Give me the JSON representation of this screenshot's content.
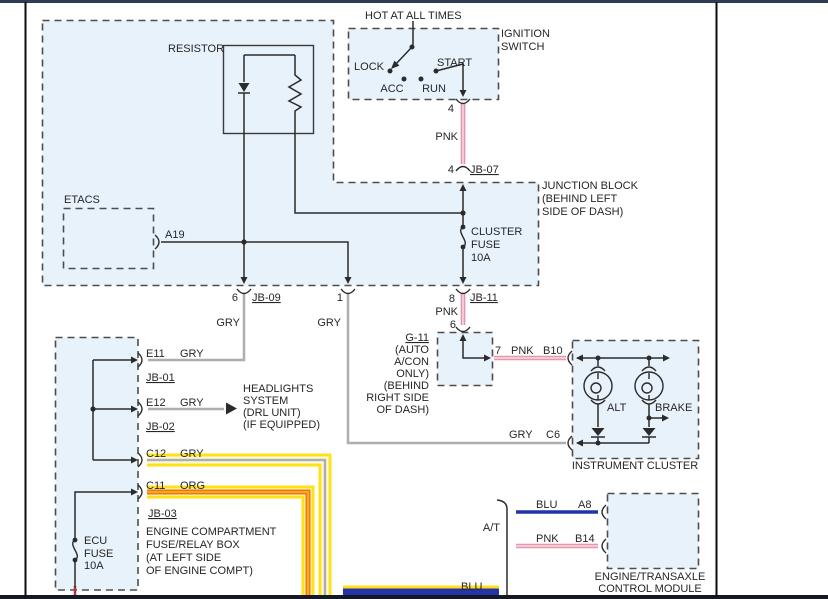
{
  "colors": {
    "box_fill": "#e8f2fa",
    "box_border": "#4d4d4d",
    "wire": "#2b2b2b",
    "text": "#262626",
    "gry": "#aeaeae",
    "pnk_edge": "#dc8aa0",
    "pnk_core": "#f7c9d5",
    "org_edge": "#e26c0c",
    "org_core": "#ffa51f",
    "blu": "#2433a8",
    "red": "#b23434",
    "highlight": "#ffe215",
    "highlight_soft": "#fffbe0",
    "top_bar": "#2d3c50",
    "bottom_bar": "#151923",
    "page_border": "#0b0b0b"
  },
  "feed": {
    "hot": "HOT AT ALL TIMES"
  },
  "ignition": {
    "label1": "IGNITION",
    "label2": "SWITCH",
    "lock": "LOCK",
    "acc": "ACC",
    "run": "RUN",
    "start": "START",
    "pin_out": "4",
    "wire": "PNK",
    "pin_in": "4",
    "connector": "JB-07"
  },
  "resistor": {
    "label": "RESISTOR"
  },
  "etacs": {
    "label": "ETACS",
    "pin": "A19"
  },
  "junction_block": {
    "label1": "JUNCTION BLOCK",
    "label2": "(BEHIND LEFT",
    "label3": "SIDE OF DASH)",
    "fuse1": "CLUSTER",
    "fuse2": "FUSE",
    "fuse3": "10A"
  },
  "jb09": {
    "pin": "6",
    "label": "JB-09",
    "wire": "GRY"
  },
  "jb_mid": {
    "pin": "1",
    "wire": "GRY"
  },
  "jb11": {
    "pin": "8",
    "label": "JB-11",
    "wire": "PNK",
    "pin2": "6"
  },
  "g11": {
    "name": "G-11",
    "note1": "(AUTO",
    "note2": "A/CON",
    "note3": "ONLY)",
    "note4": "(BEHIND",
    "note5": "RIGHT SIDE",
    "note6": "OF DASH)",
    "pin_out": "7"
  },
  "cluster": {
    "title": "INSTRUMENT CLUSTER",
    "wire_in": "PNK",
    "pin_in": "B10",
    "alt": "ALT",
    "brake": "BRAKE",
    "wire_out": "GRY",
    "pin_out": "C6"
  },
  "fuse_box": {
    "title1": "ENGINE COMPARTMENT",
    "title2": "FUSE/RELAY BOX",
    "title3": "(AT LEFT SIDE",
    "title4": "OF ENGINE COMPT)",
    "ecu1": "ECU",
    "ecu2": "FUSE",
    "ecu3": "10A",
    "e11": {
      "pin": "E11",
      "wire": "GRY",
      "jb": "JB-01"
    },
    "e12": {
      "pin": "E12",
      "wire": "GRY",
      "jb": "JB-02"
    },
    "c12": {
      "pin": "C12",
      "wire": "GRY"
    },
    "c11": {
      "pin": "C11",
      "wire": "ORG",
      "jb": "JB-03"
    }
  },
  "headlights": {
    "line1": "HEADLIGHTS",
    "line2": "SYSTEM",
    "line3": "(DRL UNIT)",
    "line4": "(IF EQUIPPED)"
  },
  "at_section": {
    "label": "A/T",
    "blu_wire": "BLU",
    "blu_pin": "A8",
    "pnk_wire": "PNK",
    "pnk_pin": "B14",
    "blu_bottom": "BLU"
  },
  "module": {
    "title1": "ENGINE/TRANSAXLE",
    "title2": "CONTROL MODULE"
  }
}
